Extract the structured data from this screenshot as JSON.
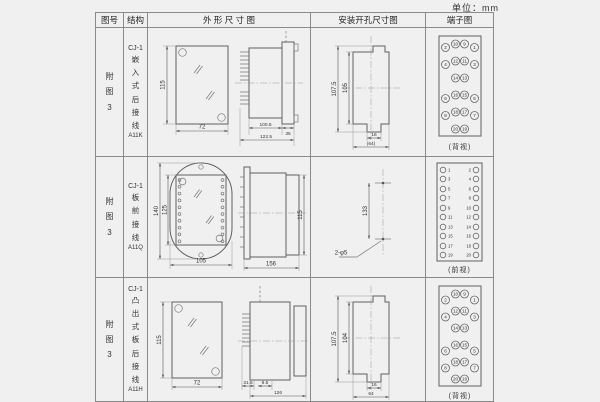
{
  "page": {
    "unit_label": "单位：mm"
  },
  "table": {
    "headers": {
      "fig_no": "图号",
      "structure": "结构",
      "outline": "外 形 尺 寸 图",
      "install": "安装开孔尺寸图",
      "terminal": "端子图"
    }
  },
  "rows": [
    {
      "fig_no": "附图3",
      "model": "CJ-1",
      "structure": "嵌入式后接线",
      "code": "A11K",
      "outline": {
        "front_h": "115",
        "front_w": "72",
        "depth_body": "100.5",
        "depth_total": "122.5",
        "flange": "35"
      },
      "install": {
        "outer_h": "107.5",
        "inner_h": "105",
        "slot_w": "16",
        "total_w": "(64)"
      },
      "terminal": {
        "view": "(背视)",
        "rows": [
          [
            2,
            10,
            9,
            1
          ],
          [
            4,
            12,
            11,
            3
          ],
          [
            14,
            13
          ],
          [
            6,
            16,
            15,
            5
          ],
          [
            8,
            18,
            17,
            7
          ],
          [
            20,
            19
          ]
        ]
      }
    },
    {
      "fig_no": "附图3",
      "model": "CJ-1",
      "structure": "板前接线",
      "code": "A11Q",
      "outline": {
        "front_h_outer": "140",
        "front_h_inner": "125",
        "front_w": "105",
        "depth_total": "156",
        "side_h": "115"
      },
      "install": {
        "hole_pitch": "133",
        "hole_label": "2-φ5"
      },
      "terminal": {
        "view": "(前视)",
        "left": [
          1,
          3,
          5,
          7,
          9,
          11,
          13,
          15,
          17,
          19
        ],
        "right": [
          2,
          4,
          6,
          8,
          10,
          12,
          14,
          16,
          18,
          20
        ]
      }
    },
    {
      "fig_no": "附图3",
      "model": "CJ-1",
      "structure": "凸出式板后接线",
      "code": "A11H",
      "outline": {
        "front_h": "115",
        "front_w": "72",
        "pin_len": "31.5",
        "offset": "9.5",
        "depth_total": "126"
      },
      "install": {
        "outer_h": "107.5",
        "inner_h": "104",
        "slot_w": "16",
        "total_w": "64"
      },
      "terminal": {
        "view": "(背视)",
        "rows": [
          [
            2,
            10,
            9,
            1
          ],
          [
            4,
            12,
            11,
            3
          ],
          [
            14,
            13
          ],
          [
            6,
            16,
            15,
            5
          ],
          [
            8,
            18,
            17,
            7
          ],
          [
            20,
            19
          ]
        ]
      }
    }
  ]
}
